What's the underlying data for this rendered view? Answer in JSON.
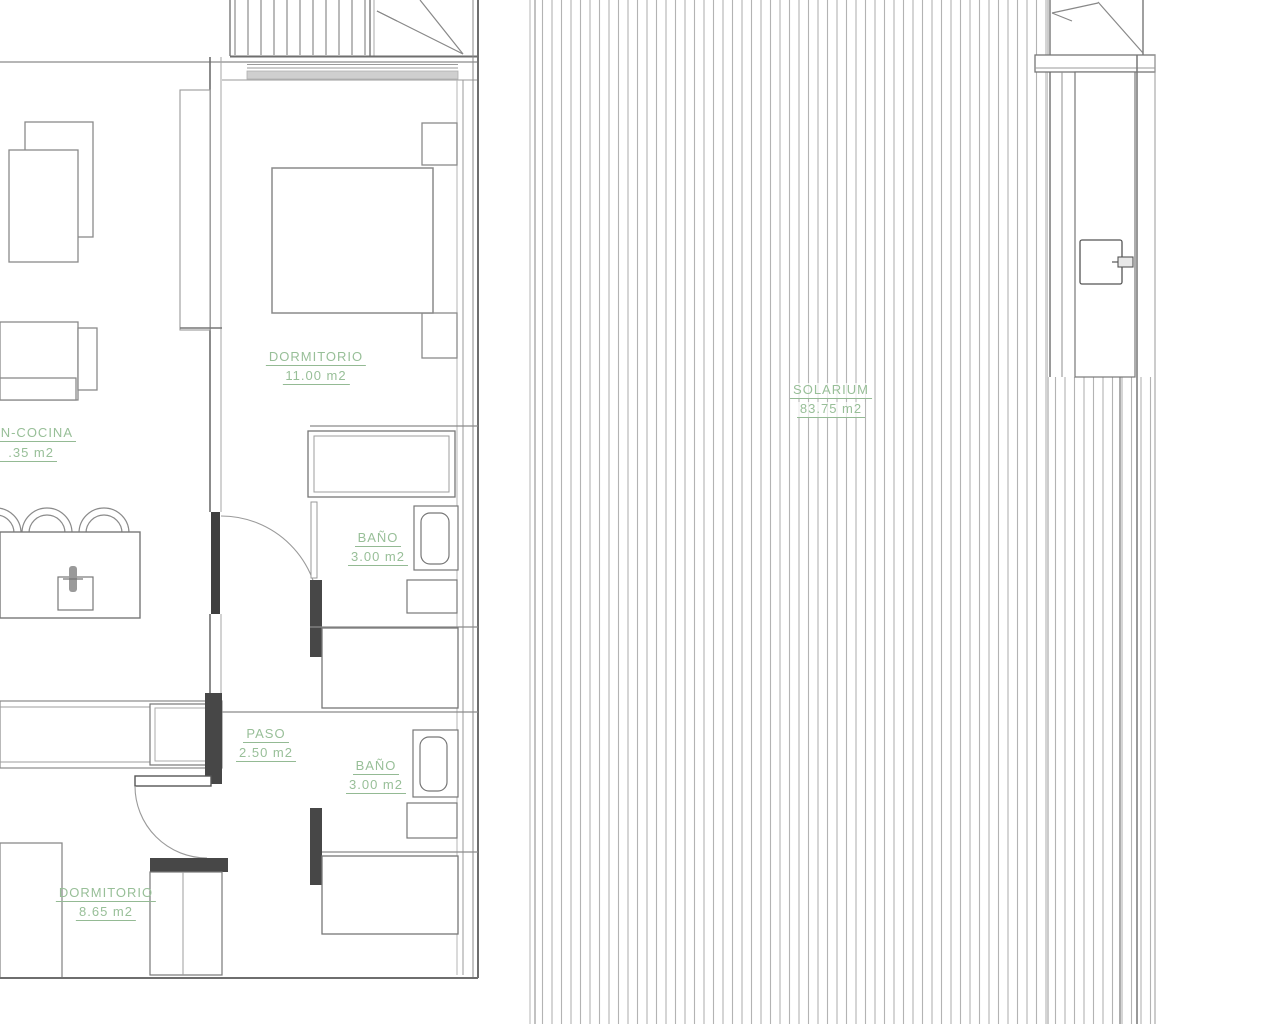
{
  "plan": {
    "kind": "architectural-floor-plan",
    "label_color": "#98bf98",
    "wall_color": "#777777",
    "hatch_color": "#b3b3b3",
    "rooms": [
      {
        "id": "dormitorio-1",
        "name": "DORMITORIO",
        "area": "11.00 m2"
      },
      {
        "id": "salon-cocina",
        "name": "N-COCINA",
        "area": ".35 m2"
      },
      {
        "id": "bano-1",
        "name": "BAÑO",
        "area": "3.00 m2"
      },
      {
        "id": "paso",
        "name": "PASO",
        "area": "2.50 m2"
      },
      {
        "id": "bano-2",
        "name": "BAÑO",
        "area": "3.00 m2"
      },
      {
        "id": "dormitorio-2",
        "name": "DORMITORIO",
        "area": "8.65 m2"
      },
      {
        "id": "solarium",
        "name": "SOLARIUM",
        "area": "83.75 m2"
      }
    ]
  }
}
